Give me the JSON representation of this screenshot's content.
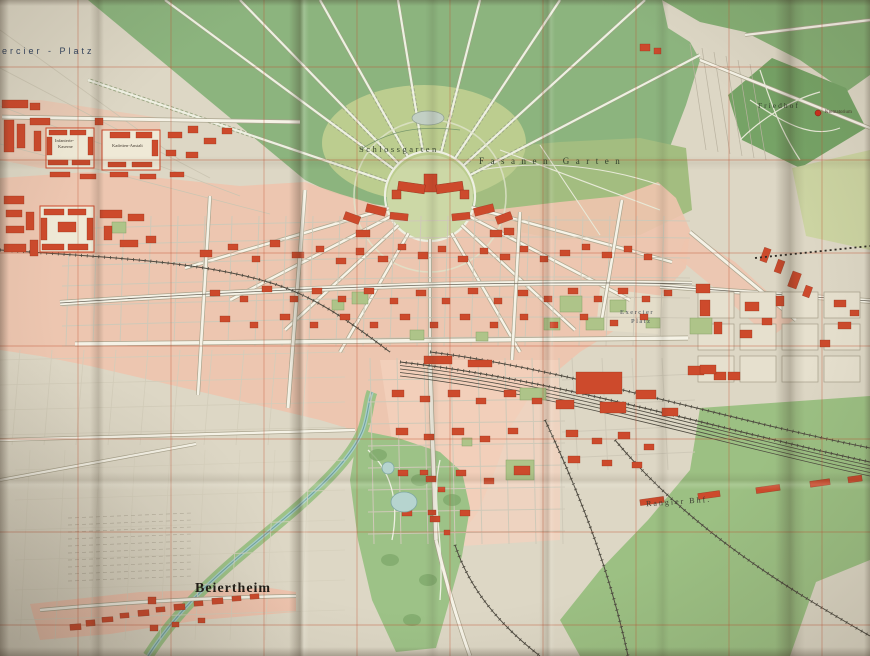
{
  "map": {
    "labels": {
      "mercier_platz": "ercier - Platz",
      "schlossgarten": "Schlossgarten",
      "fasanen_garten": "Fasanen Garten",
      "friedhof": "Friedhof",
      "krematorium": "Krematorium",
      "exercier_platz_line1": "Exercier",
      "exercier_platz_line2": "Platz",
      "rangier_bhf": "Rangier Bhf.",
      "beiertheim": "Beiertheim",
      "infanterie_kaserne_line1": "Infanterie-",
      "infanterie_kaserne_line2": "Kaserne",
      "kadetten_anstalt": "Kadetten-Anstalt"
    },
    "colors": {
      "paper_cream": "#ddd7c5",
      "forest_green": "#8cb47e",
      "forest_dark": "#85ae74",
      "friedhof_green": "#76a366",
      "park_light": "#bccd8f",
      "fasanengarten_green": "#a3bd80",
      "meadow_green": "#9cc083",
      "urban_pink": "#eec4ae",
      "building_red": "#cd4a2c",
      "survey_grid_red": "#c14f2e",
      "water_blue": "#a8cdc8",
      "rail_dark": "#4e4a40"
    }
  }
}
